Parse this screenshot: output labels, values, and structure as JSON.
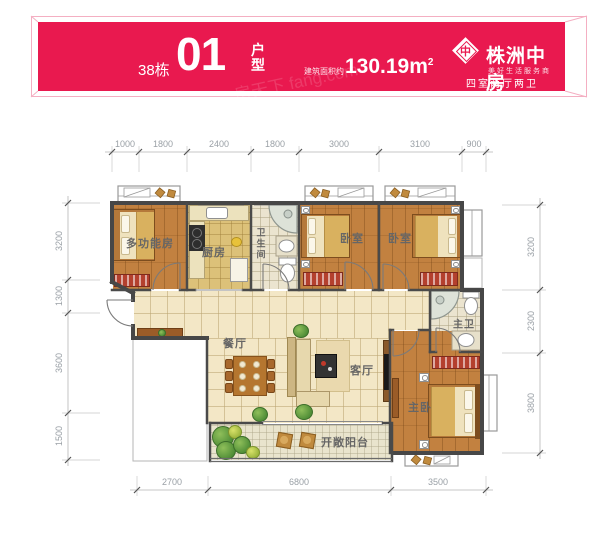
{
  "header": {
    "building": "38栋",
    "unit_number": "01",
    "unit_type": "户型",
    "area_label": "建筑面积约",
    "area_value": "130.19m",
    "area_sup": "2",
    "brand": "株洲中房",
    "brand_icon_char": "中",
    "brand_tagline": "美好生活服务商",
    "layout_summary": "四室两厅两卫",
    "banner_color": "#e9194f"
  },
  "watermark": {
    "text": "房天下 fang.com"
  },
  "dimensions": {
    "top": [
      "1000",
      "1800",
      "2400",
      "1800",
      "3000",
      "3100",
      "900"
    ],
    "left": [
      "3200",
      "1300",
      "3600",
      "1500"
    ],
    "right": [
      "3200",
      "2300",
      "3800"
    ],
    "bottom": [
      "2700",
      "6800",
      "3500"
    ]
  },
  "rooms": {
    "multi": "多功能房",
    "kitchen": "厨房",
    "bath": "卫生间",
    "bedroom1": "卧室",
    "bedroom2": "卧室",
    "dining": "餐厅",
    "living": "客厅",
    "master_bath": "主卫",
    "master_bedroom": "主卧",
    "balcony": "开敞阳台"
  },
  "palette": {
    "banner": "#e9194f",
    "wood_floor": "#c28140",
    "hall_tile": "#f3e7c6",
    "wall": "#4a4a4a",
    "wardrobe_red": "#b4402e"
  }
}
